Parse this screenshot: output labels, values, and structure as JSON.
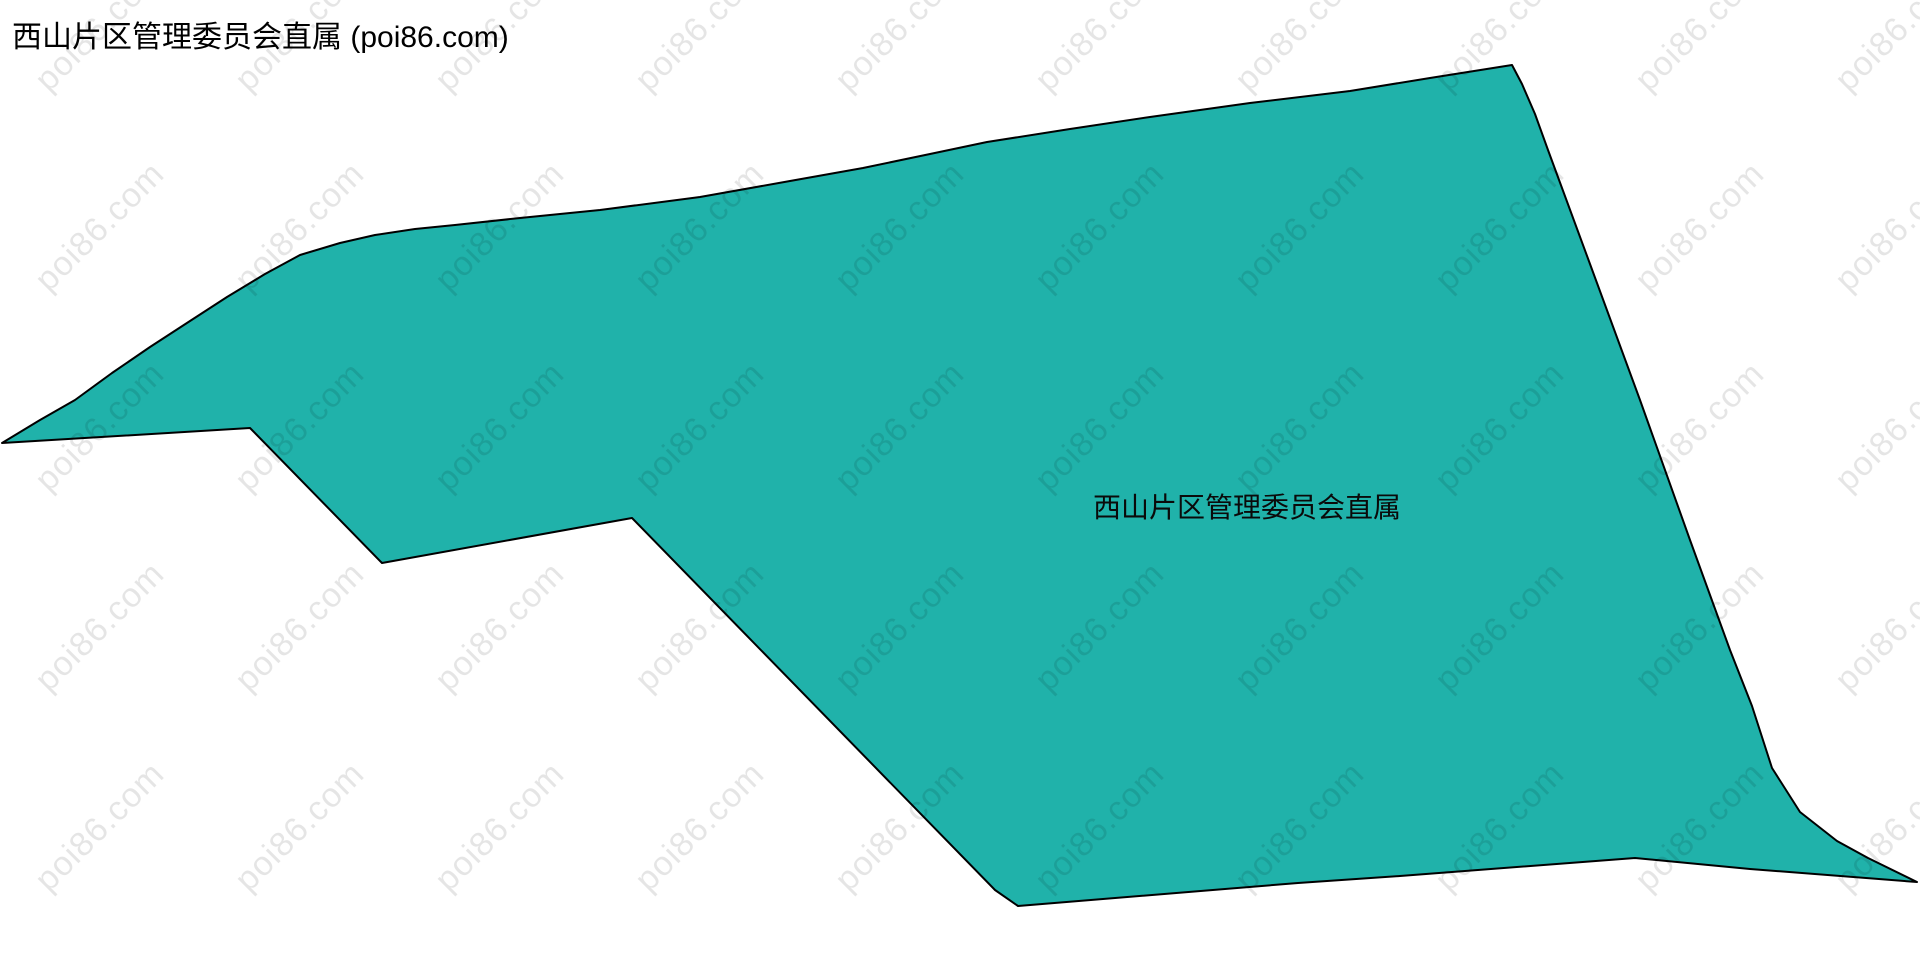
{
  "page": {
    "title": "西山片区管理委员会直属 (poi86.com)"
  },
  "map": {
    "region_label": "西山片区管理委员会直属",
    "fill_color": "#20b2aa",
    "border_color": "#000000",
    "boundary_points": [
      [
        2,
        443
      ],
      [
        40,
        420
      ],
      [
        75,
        400
      ],
      [
        112,
        373
      ],
      [
        150,
        347
      ],
      [
        190,
        321
      ],
      [
        227,
        297
      ],
      [
        265,
        274
      ],
      [
        300,
        255
      ],
      [
        340,
        243
      ],
      [
        375,
        235
      ],
      [
        415,
        229
      ],
      [
        455,
        225
      ],
      [
        520,
        218
      ],
      [
        600,
        210
      ],
      [
        700,
        197
      ],
      [
        790,
        181
      ],
      [
        863,
        168
      ],
      [
        930,
        154
      ],
      [
        987,
        142
      ],
      [
        1070,
        129
      ],
      [
        1150,
        117
      ],
      [
        1250,
        103
      ],
      [
        1350,
        91
      ],
      [
        1430,
        78
      ],
      [
        1512,
        65
      ],
      [
        1522,
        84
      ],
      [
        1535,
        114
      ],
      [
        1548,
        150
      ],
      [
        1590,
        264
      ],
      [
        1640,
        400
      ],
      [
        1690,
        540
      ],
      [
        1730,
        650
      ],
      [
        1752,
        706
      ],
      [
        1772,
        768
      ],
      [
        1800,
        812
      ],
      [
        1837,
        841
      ],
      [
        1868,
        858
      ],
      [
        1917,
        882
      ],
      [
        1750,
        869
      ],
      [
        1635,
        858
      ],
      [
        1400,
        876
      ],
      [
        1298,
        883
      ],
      [
        1018,
        906
      ],
      [
        995,
        890
      ],
      [
        632,
        518
      ],
      [
        382,
        563
      ],
      [
        250,
        428
      ]
    ]
  },
  "watermark": {
    "text": "poi86.com",
    "color": "rgba(0,0,0,0.10)"
  }
}
